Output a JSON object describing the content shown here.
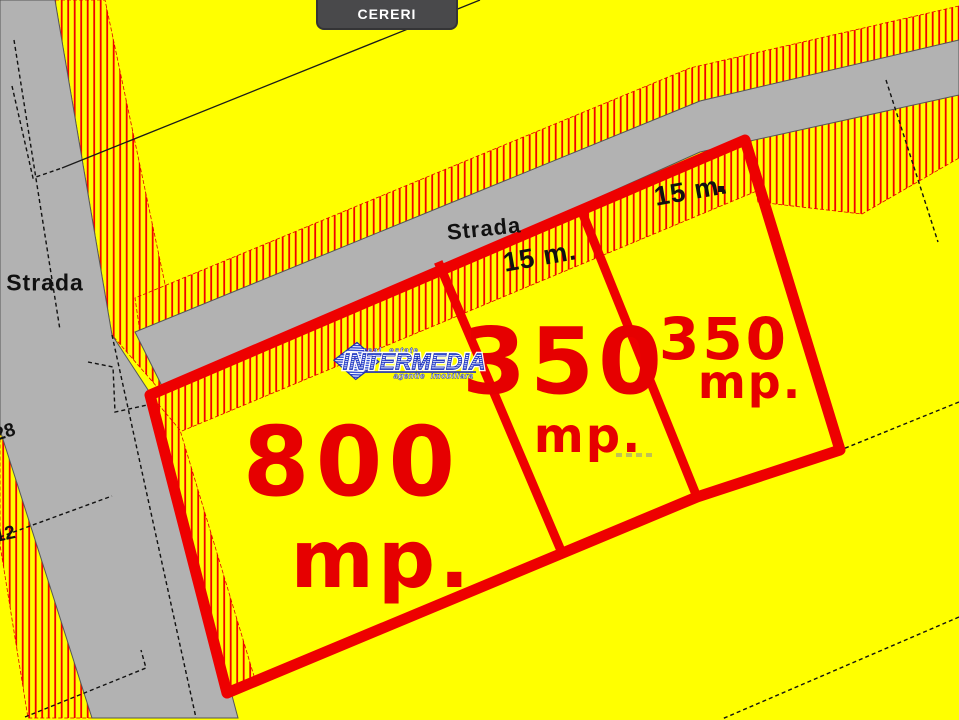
{
  "header": {
    "cereri_label": "CERERI"
  },
  "map": {
    "road_labels": [
      {
        "text": "Strada"
      },
      {
        "text": "Strada"
      }
    ],
    "frontage_labels": [
      {
        "text": "15 m."
      },
      {
        "text": "15 m."
      }
    ],
    "parcels": [
      {
        "area": "800",
        "unit": "mp."
      },
      {
        "area": "350",
        "unit": "mp."
      },
      {
        "area": "350",
        "unit": "mp."
      }
    ],
    "plot_numbers": [
      "28",
      "12"
    ],
    "colors": {
      "background": "#ffff00",
      "road": "#b2b2b2",
      "parcel_outline": "#ee0000",
      "hatch_line": "#f30000",
      "button": "#49494b",
      "watermark_blue": "#2133b8"
    }
  },
  "watermark": {
    "tagline_top": "real estate",
    "brand": "INTERMEDIA",
    "tagline_bottom": "agentie imobiliara"
  }
}
